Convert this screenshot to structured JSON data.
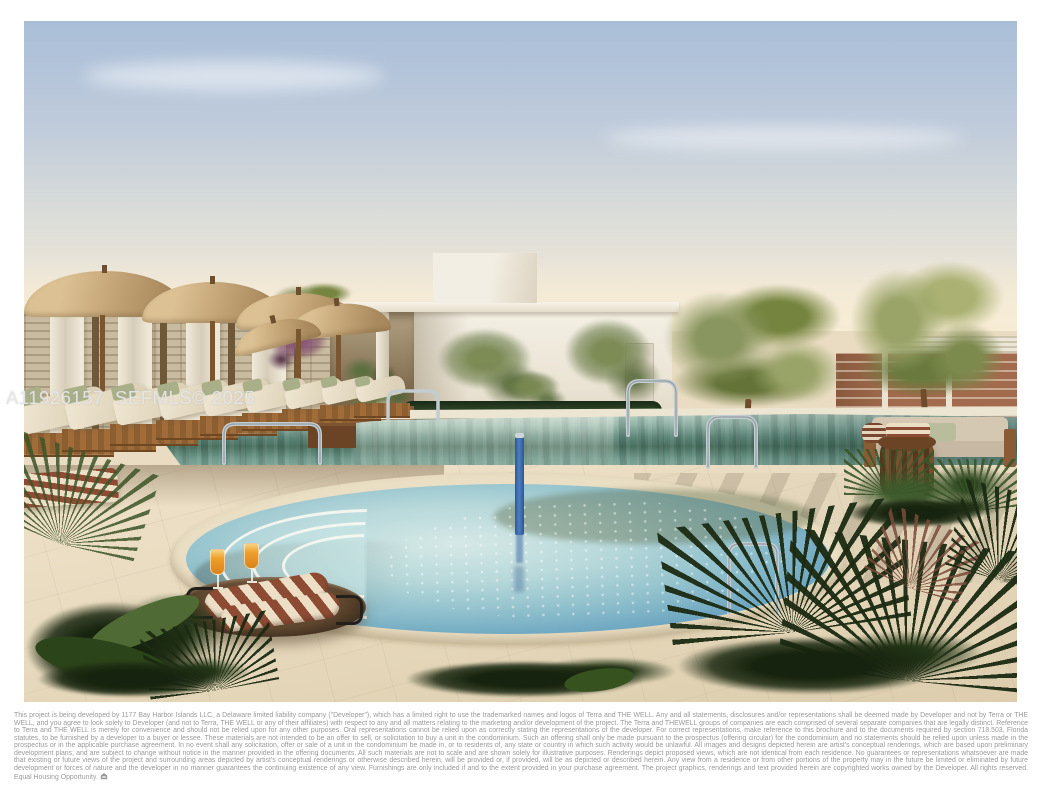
{
  "watermark": {
    "text": "A11926157  SEFMLS© 2025"
  },
  "disclaimer": {
    "text": "This project is being developed by 1177 Bay Harbor Islands LLC, a Delaware limited liability company (\"Developer\"), which has a limited right to use the trademarked names and logos of Terra and THE WELL.  Any and all statements, disclosures and/or representations shall be deemed made by Developer and not by Terra or THE WELL, and you agree to look solely to Developer (and not to Terra, THE WELL or any of their affiliates) with respect to any and all matters relating to the marketing and/or development of the project. The Terra and THEWELL groups of companies are each comprised of several separate companies that are legally distinct. Reference to Terra and THE WELL is merely for convenience and should not be relied upon for any other purposes. Oral representations cannot be relied upon as correctly stating the representations of the developer. For correct representations, make reference to this brochure and to the documents required by section 718.503, Florida statutes, to be furnished by a developer to a buyer or lessee. These materials are not intended to be an offer to sell, or solicitation to buy a unit in the condominium. Such an offering shall only be made pursuant to the prospectus (offering circular) for the condominium and no statements should be relied upon unless made in the prospectus or in the applicable purchase agreement. In no event shall any solicitation, offer or sale of a unit in the condominium be made in, or to residents of, any state or country in which such activity would be unlawful. All images and designs depicted herein are artist's conceptual renderings, which are based upon preliminary development plans, and are subject to change without notice in the manner provided in the offering documents. All such materials are not to scale and are shown solely for illustrative purposes.  Renderings depict proposed views, which are not identical from each residence.  No guarantees or representations whatsoever are made that existing or future views of the project and surrounding areas depicted by artist's conceptual renderings or otherwise described herein, will be provided or, if provided, will be as depicted or described herein.  Any view from a residence or from other portions of the property may in the future be limited or eliminated by future development or forces of nature and the developer in no manner guarantees the continuing existence of any view.  Furnishings are only included if and to the extent provided in your purchase agreement. The project graphics, renderings and text provided herein are copyrighted works owned by the Developer. All rights reserved. Equal Housing Opportunity.",
    "icon": "equal-housing-icon"
  },
  "palette": {
    "sky_top": "#a9bed8",
    "sky_horizon": "#f7efde",
    "deck": "#e9dcc2",
    "pool": "#5d8578",
    "spa": "#93c2cd",
    "umbrella": "#c3a476",
    "wood": "#7a572f",
    "cushion": "#f0e7d3",
    "sage": "#a9b089",
    "towel_rust": "#8d4b34",
    "towel_cream": "#ecdfc6",
    "terracotta": "#a26b4d",
    "juice": "#ef9f2b",
    "pole_blue": "#4d7ec2",
    "disclaimer": "#9a9a9a"
  }
}
